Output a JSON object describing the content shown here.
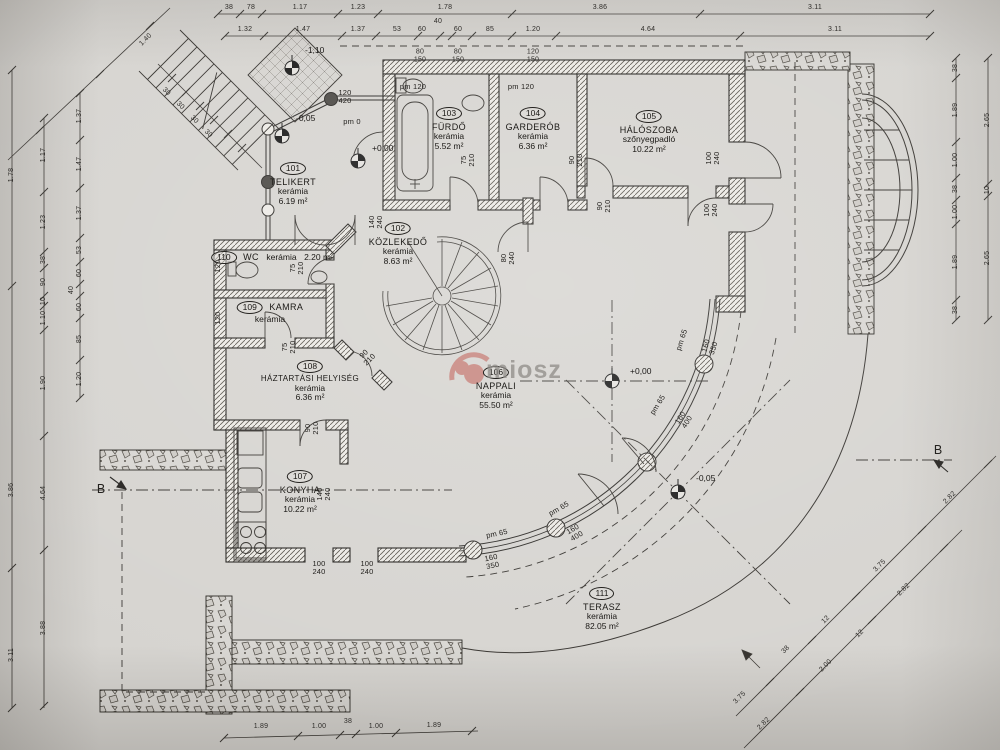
{
  "watermark": {
    "text": "miosz",
    "logo_color": "#b8392e"
  },
  "rooms": [
    {
      "num": "101",
      "name": "TELIKERT",
      "floor": "kerámia",
      "area": "6.19 m²"
    },
    {
      "num": "102",
      "name": "KÖZLEKEDŐ",
      "floor": "kerámia",
      "area": "8.63 m²"
    },
    {
      "num": "103",
      "name": "FÜRDŐ",
      "floor": "kerámia",
      "area": "5.52 m²"
    },
    {
      "num": "104",
      "name": "GARDERÓB",
      "floor": "kerámia",
      "area": "6.36 m²"
    },
    {
      "num": "105",
      "name": "HÁLÓSZOBA",
      "floor": "szőnyegpadló",
      "area": "10.22 m²"
    },
    {
      "num": "106",
      "name": "NAPPALI",
      "floor": "kerámia",
      "area": "55.50 m²"
    },
    {
      "num": "107",
      "name": "KONYHA",
      "floor": "kerámia",
      "area": "10.22 m²"
    },
    {
      "num": "108",
      "name": "HÁZTARTÁSI HELYISÉG",
      "floor": "kerámia",
      "area": "6.36 m²"
    },
    {
      "num": "109",
      "name": "KAMRA",
      "floor": "kerámia",
      "area": "2.87 m²"
    },
    {
      "num": "110",
      "name": "WC",
      "floor": "kerámia",
      "area": "2.20 m²"
    },
    {
      "num": "111",
      "name": "TERASZ",
      "floor": "kerámia",
      "area": "82.05 m²"
    }
  ],
  "levels": {
    "a": "+0,00",
    "b": "+0,00",
    "c": "-0,05",
    "d": "-0,05",
    "e": "-1,10"
  },
  "sections": {
    "left": "B",
    "right": "B"
  },
  "dims": {
    "top1": [
      "38",
      "78",
      "1.17",
      "1.23",
      "1.78",
      "3.86",
      "3.11"
    ],
    "top2": [
      "1.32",
      "1.47",
      "1.37",
      "53",
      "60",
      "40",
      "60",
      "85",
      "1.20",
      "4.64",
      "3.11"
    ],
    "windows": [
      "80\n150",
      "80\n150",
      "120\n150"
    ],
    "left_outer": [
      "1.78",
      "3.86",
      "3.11"
    ],
    "left_mid": [
      "1.17",
      "1.23",
      "38",
      "90",
      "10",
      "1.10",
      "1.90",
      "4.64",
      "3.88"
    ],
    "left_inner": [
      "1.37",
      "1.47",
      "1.37",
      "53",
      "60",
      "40",
      "60",
      "85",
      "1.20"
    ],
    "right_inner": [
      "38",
      "1.89",
      "1.00",
      "38",
      "1.00",
      "1.89",
      "38"
    ],
    "right_outer": [
      "2.65",
      "10",
      "2.65"
    ],
    "bottom": [
      "1.89",
      "1.00",
      "38",
      "1.00",
      "1.89"
    ],
    "diag_upper": [
      "3.75",
      "38",
      "12",
      "3.75",
      "2.82"
    ],
    "diag_lower": [
      "2.82",
      "2.00",
      "12",
      "2.82"
    ],
    "stair_steps": [
      "30",
      "30",
      "30",
      "30"
    ],
    "stair_run": "1.40"
  },
  "plan_labels": [
    "pm 120",
    "pm 120",
    "120\n420",
    "pm 0",
    "75\n210",
    "90\n210",
    "90\n210",
    "100\n240",
    "100\n240",
    "120",
    "120",
    "75\n210",
    "75\n210",
    "90\n210",
    "140\n240",
    "80\n240",
    "90\n210",
    "140\n240",
    "100\n240",
    "100\n240",
    "pm 65",
    "160\n350",
    "pm 65",
    "160\n400",
    "pm 65",
    "160\n400",
    "pm 65",
    "160\n350"
  ]
}
